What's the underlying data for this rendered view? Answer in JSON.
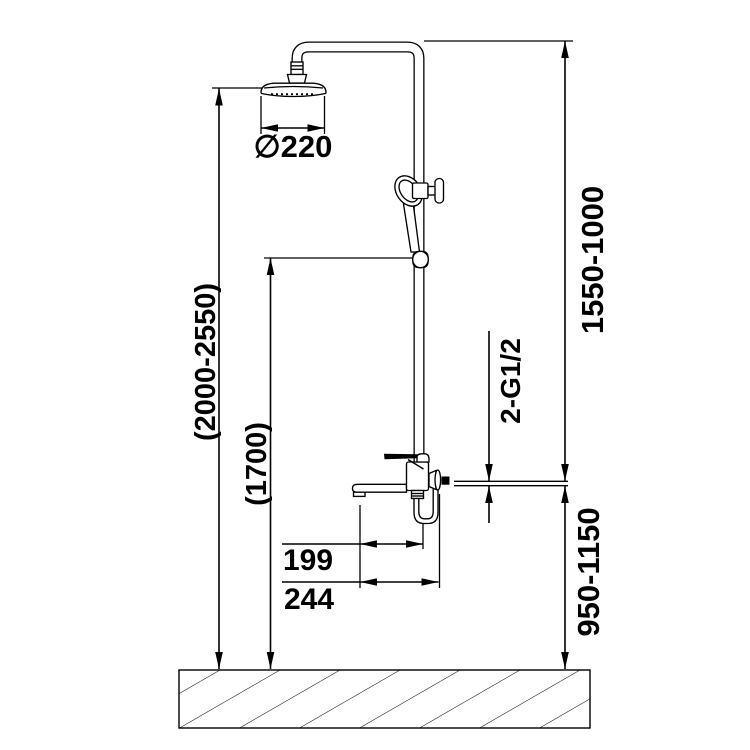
{
  "drawing": {
    "dimensions": {
      "head_diameter": "∅220",
      "overall_height": "(2000-2550)",
      "handshower_height": "(1700)",
      "upper_riser_range": "1550-1000",
      "lower_mixer_range": "950-1150",
      "thread_connections": "2-G1/2",
      "spout_reach": "199",
      "overall_depth": "244"
    }
  }
}
